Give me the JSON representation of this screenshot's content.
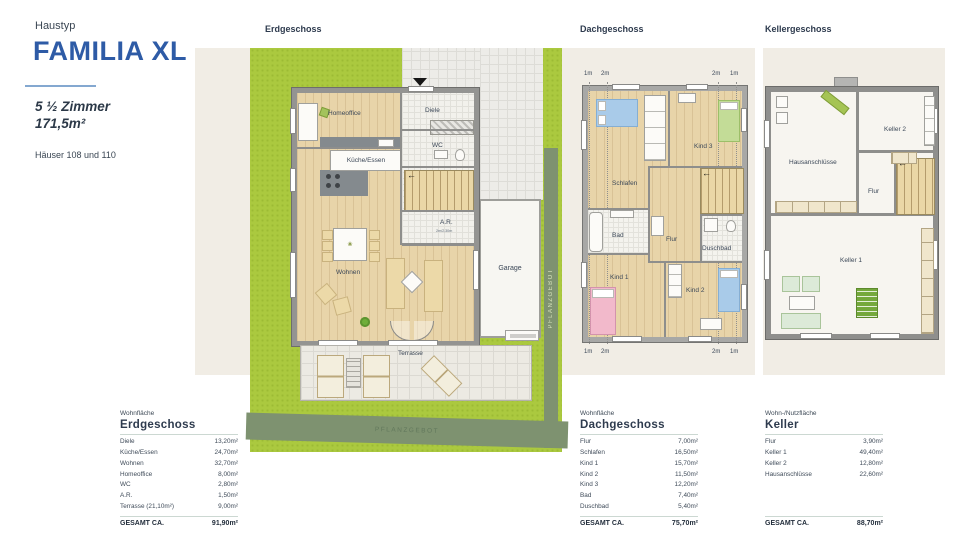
{
  "header": {
    "eyebrow": "Haustyp",
    "title": "FAMILIA XL",
    "rooms_line": "5 ½ Zimmer",
    "area_line": "171,5m²",
    "houses": "Häuser 108 und 110"
  },
  "floor_labels": {
    "eg": "Erdgeschoss",
    "dg": "Dachgeschoss",
    "kg": "Kellergeschoss"
  },
  "eg": {
    "diele": "Diele",
    "wc": "WC",
    "kueche": "Küche/Essen",
    "homeoffice": "Homeoffice",
    "wohnen": "Wohnen",
    "ar": "A.R.",
    "ar_note": "2m/2,30m",
    "terrasse": "Terrasse",
    "garage": "Garage",
    "pflanzgebot": "PFLANZGEBOT"
  },
  "dg": {
    "schlafen": "Schlafen",
    "kind1": "Kind 1",
    "kind2": "Kind 2",
    "kind3": "Kind 3",
    "bad": "Bad",
    "flur": "Flur",
    "duschbad": "Duschbad",
    "measures": [
      "1m",
      "2m",
      "2m",
      "1m"
    ]
  },
  "kg": {
    "flur": "Flur",
    "keller1": "Keller 1",
    "keller2": "Keller 2",
    "hausanschluesse": "Hausanschlüsse"
  },
  "tables": [
    {
      "category": "Wohnfläche",
      "title": "Erdgeschoss",
      "rows": [
        {
          "label": "Diele",
          "value": "13,20m²"
        },
        {
          "label": "Küche/Essen",
          "value": "24,70m²"
        },
        {
          "label": "Wohnen",
          "value": "32,70m²"
        },
        {
          "label": "Homeoffice",
          "value": "8,00m²"
        },
        {
          "label": "WC",
          "value": "2,80m²"
        },
        {
          "label": "A.R.",
          "value": "1,50m²"
        },
        {
          "label": "Terrasse (21,10m²)",
          "value": "9,00m²"
        }
      ],
      "total_label": "GESAMT CA.",
      "total_value": "91,90m²"
    },
    {
      "category": "Wohnfläche",
      "title": "Dachgeschoss",
      "rows": [
        {
          "label": "Flur",
          "value": "7,00m²"
        },
        {
          "label": "Schlafen",
          "value": "16,50m²"
        },
        {
          "label": "Kind 1",
          "value": "15,70m²"
        },
        {
          "label": "Kind 2",
          "value": "11,50m²"
        },
        {
          "label": "Kind 3",
          "value": "12,20m²"
        },
        {
          "label": "Bad",
          "value": "7,40m²"
        },
        {
          "label": "Duschbad",
          "value": "5,40m²"
        }
      ],
      "total_label": "GESAMT CA.",
      "total_value": "75,70m²"
    },
    {
      "category": "Wohn-/Nutzfläche",
      "title": "Keller",
      "rows": [
        {
          "label": "Flur",
          "value": "3,90m²"
        },
        {
          "label": "Keller 1",
          "value": "49,40m²"
        },
        {
          "label": "Keller 2",
          "value": "12,80m²"
        },
        {
          "label": "Hausanschlüsse",
          "value": "22,60m²"
        }
      ],
      "total_label": "GESAMT CA.",
      "total_value": "88,70m²"
    }
  ],
  "colors": {
    "brand_blue": "#2e5ba6",
    "garden": "#abc93f",
    "hedge": "#7e9270",
    "panel_beige": "#f1ede5",
    "wood": "#e8d4a9"
  }
}
